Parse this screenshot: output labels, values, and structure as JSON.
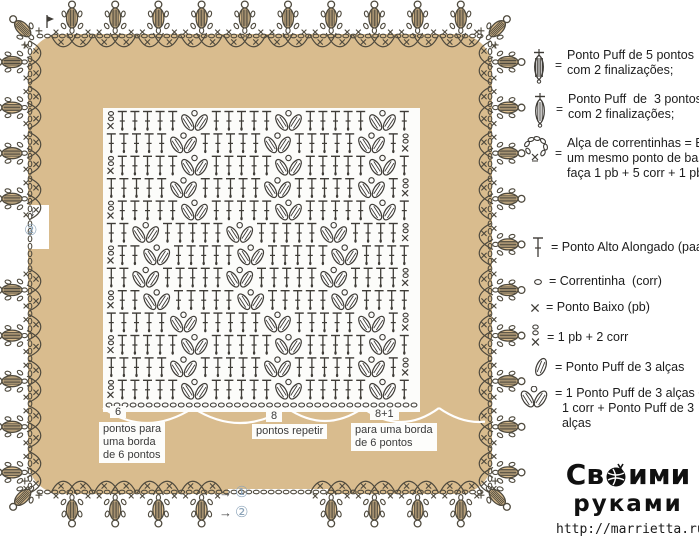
{
  "colors": {
    "tan": "#d9bc8e",
    "stroke": "#4f4a3e",
    "symbol": "#3f3c37",
    "white": "#ffffff",
    "circled_num": "#8ba3b8"
  },
  "chart": {
    "description": "crochet stitch chart",
    "rows": [
      "ETTTTTVTTTTTVTTTTTVT",
      "TTTTTVTTTTTVTTTTTVTF",
      "ETTTTTVTTTTTVTTTTTVT",
      "TTTTTVTTTTTVTTTTTVTF",
      "ETTTTTVTTTTTVTTTTTVT",
      "TTVTTTTTVTTTTTVTTTTF",
      "ETTVTTTTTVTTTTTVTTTT",
      "TTVTTTTTVTTTTTVTTTTF",
      "ETTVTTTTTVTTTTTVTTTT",
      "TTTTTVTTTTTVTTTTTVTF",
      "ETTTTTVTTTTTVTTTTTVT",
      "TTTTTVTTTTTVTTTTTVTF",
      "ETTTTTVTTTTTVTTTTTVT"
    ],
    "chain_row_count": 39
  },
  "border": {
    "top": {
      "start": [
        72,
        36
      ],
      "dx": 43.2,
      "dy": 0,
      "angle": 0,
      "count": 10,
      "skip": []
    },
    "right": {
      "start": [
        490,
        62
      ],
      "dx": 0,
      "dy": 45.6,
      "angle": 90,
      "count": 10,
      "skip": []
    },
    "bottom": {
      "start": [
        72,
        492
      ],
      "dx": 43.2,
      "dy": 0,
      "angle": 180,
      "count": 10,
      "skip": [
        4,
        5
      ]
    },
    "left": {
      "start": [
        30,
        62
      ],
      "dx": 0,
      "dy": 45.6,
      "angle": 270,
      "count": 10,
      "skip": [
        4
      ]
    },
    "corners": [
      {
        "x": 34,
        "y": 40,
        "a": -45
      },
      {
        "x": 486,
        "y": 40,
        "a": 45
      },
      {
        "x": 486,
        "y": 486,
        "a": 135
      },
      {
        "x": 34,
        "y": 486,
        "a": -135
      }
    ],
    "chains": [
      {
        "from": [
          40,
          36
        ],
        "to": [
          480,
          36
        ]
      },
      {
        "from": [
          40,
          492
        ],
        "to": [
          480,
          492
        ]
      },
      {
        "from": [
          30,
          44
        ],
        "to": [
          30,
          486
        ]
      },
      {
        "from": [
          490,
          44
        ],
        "to": [
          490,
          486
        ]
      }
    ]
  },
  "legend": {
    "items": [
      {
        "icon": "puff5-icon",
        "eq": "=",
        "text": "Ponto Puff de 5 pontos\ncom 2 finalizações;"
      },
      {
        "icon": "puff3-icon",
        "eq": "=",
        "text": "Ponto Puff  de  3 pontos\ncom 2 finalizações;"
      },
      {
        "icon": "chain-loop-icon",
        "eq": "=",
        "text": "Alça de correntinhas = Em\num mesmo ponto de base\nfaça 1 pb + 5 corr + 1 pb"
      },
      {
        "icon": "paa-icon",
        "text": "= Ponto Alto Alongado (paa)"
      },
      {
        "icon": "chain-icon",
        "text": "= Correntinha  (corr)"
      },
      {
        "icon": "pb-icon",
        "text": "= Ponto Baixo (pb)"
      },
      {
        "icon": "pb2corr-icon",
        "text": "= 1 pb + 2 corr"
      },
      {
        "icon": "puff3-leaf-icon",
        "text": "= Ponto Puff de 3 alças"
      },
      {
        "icon": "double-puff-icon",
        "text": "= 1 Ponto Puff de 3 alças +\n  1 corr + Ponto Puff de 3\n  alças"
      }
    ]
  },
  "footer": {
    "labels": [
      {
        "num": "6",
        "text": "pontos para\numa borda\nde 6 pontos"
      },
      {
        "num": "8",
        "text": "pontos repetir"
      },
      {
        "num": "8+1",
        "text": "para uma borda\nde 6 pontos"
      }
    ],
    "arrows": {
      "right_glyph": "→",
      "down_glyph": "↓",
      "n1": "①",
      "n2": "②",
      "left_n": "②"
    }
  },
  "watermark": {
    "line1_pre": "Св",
    "line1_post": "ими",
    "line2": "руками",
    "url": "http://marrietta.ru/"
  }
}
